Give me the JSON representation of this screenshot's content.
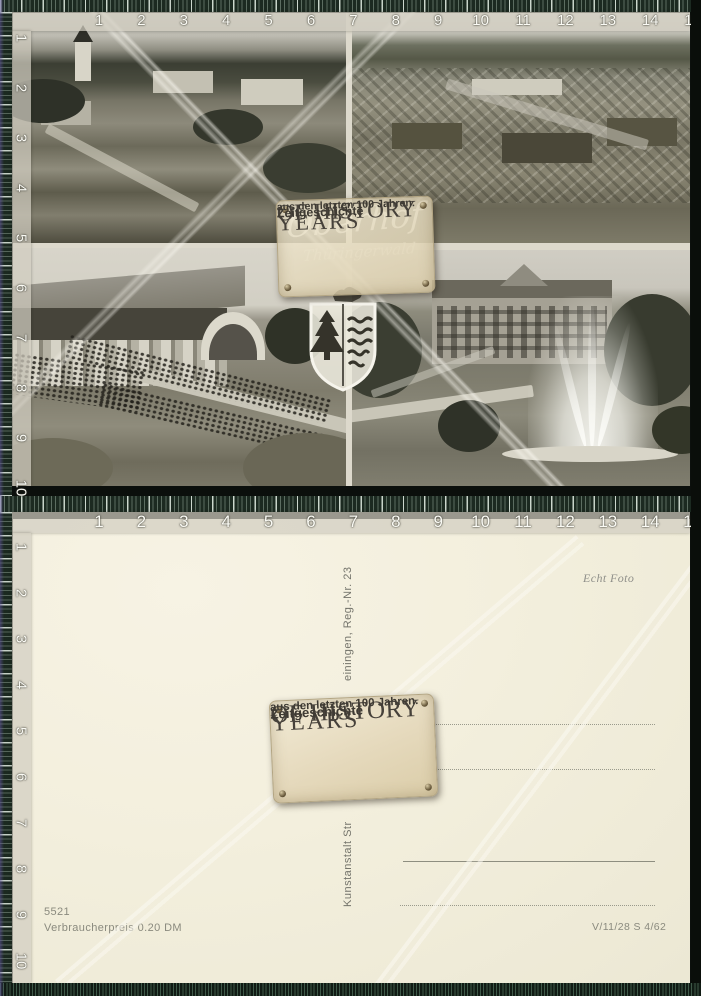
{
  "watermark": {
    "title_line1": "YEARS",
    "title_line2": "OF HISTORY",
    "subtitle_line1": "Zeitgeschichte",
    "subtitle_line2": "aus den letzten 100 Jahren."
  },
  "rulers": {
    "horizontal_numbers": [
      "1",
      "2",
      "3",
      "4",
      "5",
      "6",
      "7",
      "8",
      "9",
      "10",
      "11",
      "12",
      "13",
      "14",
      "15"
    ],
    "vertical_numbers": [
      "1",
      "2",
      "3",
      "4",
      "5",
      "6",
      "7",
      "8",
      "9",
      "10"
    ]
  },
  "front": {
    "handwriting_line1": "Oberhof",
    "handwriting_line2": "Thüringerwald",
    "photos": [
      {
        "name": "village-panorama-with-church"
      },
      {
        "name": "aerial-town-view"
      },
      {
        "name": "concert-hall-terraces-with-crowd"
      },
      {
        "name": "park-fountain-and-hotel"
      }
    ],
    "crest_name": "oberhof-coat-of-arms"
  },
  "back": {
    "photo_note": "Echt Foto",
    "publisher_upper_fragment": "einingen, Reg.-Nr. 23",
    "publisher_lower_fragment": "Kunstanstalt Str",
    "order_number": "5521",
    "price": "Verbraucherpreis 0.20 DM",
    "print_code": "V/11/28 S 4/62"
  },
  "colors": {
    "ruler_band": "#1c2a21",
    "card_back": "#f3efdd",
    "plaque": "#e9dfc4",
    "plaque_text": "#46413a"
  }
}
